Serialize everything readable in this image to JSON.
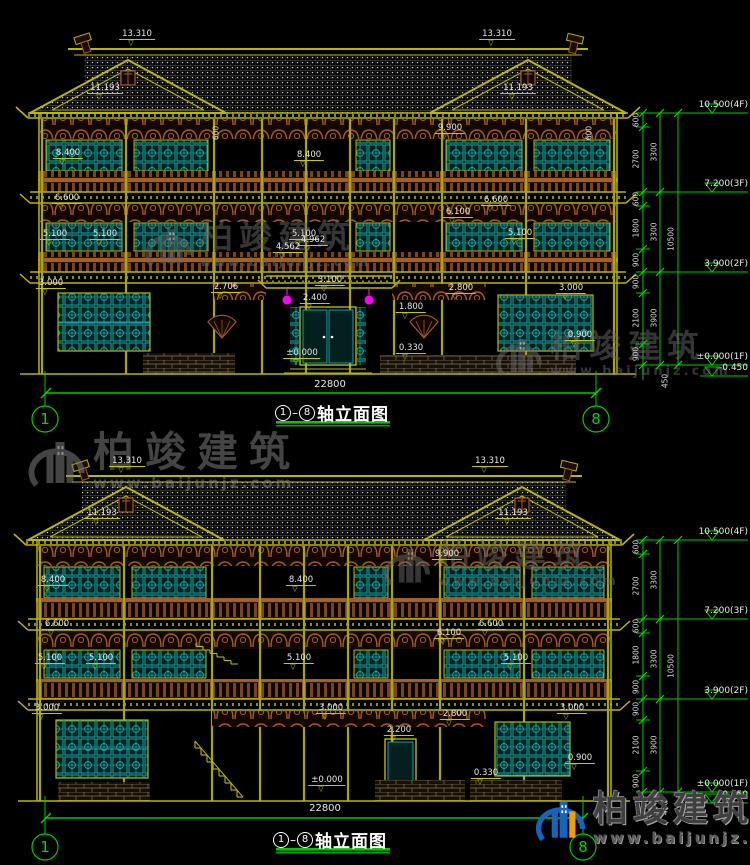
{
  "page": {
    "bg": "#000000",
    "width": 750,
    "height": 865
  },
  "colors": {
    "cad_yellow": "#b8b800",
    "dim_yellow": "#d6d600",
    "green": "#00cc00",
    "teal": "#12a3a3",
    "brown": "#a05a28",
    "magenta": "#ff00ff",
    "tile_gray": "#8f8f8f",
    "text_white": "#e8e8e8"
  },
  "watermark": {
    "brand": "柏竣建筑",
    "url": "www.baijunjz.com",
    "instances": [
      {
        "x": 143,
        "y": 220,
        "fs": 33,
        "ls": 6,
        "logo_h": 55,
        "color": "#6b6b6b",
        "opacity": 0.5,
        "colorful": false,
        "url_fs": 12
      },
      {
        "x": 494,
        "y": 330,
        "fs": 32,
        "ls": 7,
        "logo_h": 54,
        "color": "#6b6b6b",
        "opacity": 0.5,
        "colorful": false,
        "url_fs": 13
      },
      {
        "x": 26,
        "y": 431,
        "fs": 41,
        "ls": 11,
        "logo_h": 66,
        "color": "#7d7d7d",
        "opacity": 0.55,
        "colorful": false,
        "url_fs": 15
      },
      {
        "x": 382,
        "y": 540,
        "fs": 32,
        "ls": 6,
        "logo_h": 54,
        "color": "#6b6b6b",
        "opacity": 0.5,
        "colorful": false,
        "url_fs": 13
      },
      {
        "x": 534,
        "y": 792,
        "fs": 35,
        "ls": 5,
        "logo_h": 58,
        "color": "#3f3f3f",
        "opacity": 1,
        "colorful": true,
        "url_fs": 15
      }
    ]
  },
  "drawings": [
    {
      "name": "front-elevation",
      "title": {
        "axis_from": "1",
        "axis_to": "8",
        "text": "轴立面图"
      },
      "title_pos": {
        "x": 332,
        "y": 400
      },
      "width_dim": {
        "text": "22800",
        "x": 330,
        "y": 390,
        "line_y": 393,
        "x1": 46,
        "x2": 596
      },
      "axes": [
        {
          "n": "1",
          "x": 45
        },
        {
          "n": "8",
          "x": 596
        }
      ],
      "axis_cy": 419,
      "annotations": [
        {
          "t": "13.310",
          "x": 137,
          "y": 46
        },
        {
          "t": "13.310",
          "x": 497,
          "y": 46
        },
        {
          "t": "11.193",
          "x": 105,
          "y": 100
        },
        {
          "t": "11.193",
          "x": 518,
          "y": 100
        },
        {
          "t": "9.900",
          "x": 450,
          "y": 140
        },
        {
          "t": "8.400",
          "x": 68,
          "y": 165
        },
        {
          "t": "8.400",
          "x": 309,
          "y": 167
        },
        {
          "t": "6.600",
          "x": 67,
          "y": 210
        },
        {
          "t": "6.600",
          "x": 496,
          "y": 212
        },
        {
          "t": "6.100",
          "x": 458,
          "y": 224
        },
        {
          "t": "5.100",
          "x": 55,
          "y": 246
        },
        {
          "t": "5.100",
          "x": 105,
          "y": 246
        },
        {
          "t": "5.100",
          "x": 304,
          "y": 246
        },
        {
          "t": "5.100",
          "x": 520,
          "y": 245
        },
        {
          "t": "4.962",
          "x": 313,
          "y": 252
        },
        {
          "t": "4.562",
          "x": 288,
          "y": 259
        },
        {
          "t": "3.100",
          "x": 330,
          "y": 292
        },
        {
          "t": "2.400",
          "x": 315,
          "y": 310
        },
        {
          "t": "3.000",
          "x": 51,
          "y": 295
        },
        {
          "t": "3.000",
          "x": 571,
          "y": 300
        },
        {
          "t": "2.706",
          "x": 226,
          "y": 299
        },
        {
          "t": "2.800",
          "x": 461,
          "y": 300
        },
        {
          "t": "1.800",
          "x": 411,
          "y": 319
        },
        {
          "t": "0.900",
          "x": 580,
          "y": 347
        },
        {
          "t": "0.330",
          "x": 411,
          "y": 360
        },
        {
          "t": "±0.000",
          "x": 302,
          "y": 365
        },
        {
          "t": "600",
          "x": 216,
          "y": 133,
          "rot": true
        },
        {
          "t": "600",
          "x": 589,
          "y": 133,
          "rot": true
        }
      ],
      "right_col": {
        "levels": [
          {
            "t": "10.500(4F)",
            "line_y": 113
          },
          {
            "t": "7.200(3F)",
            "line_y": 192
          },
          {
            "t": "3.900(2F)",
            "line_y": 272
          },
          {
            "t": "±0.000(1F)",
            "line_y": 365
          },
          {
            "t": "-0.450",
            "line_y": 376,
            "minor": true
          }
        ],
        "vdims": [
          {
            "t": "600",
            "x": 636,
            "y": 120
          },
          {
            "t": "2700",
            "x": 636,
            "y": 159
          },
          {
            "t": "600",
            "x": 636,
            "y": 199
          },
          {
            "t": "1800",
            "x": 636,
            "y": 228
          },
          {
            "t": "900",
            "x": 636,
            "y": 260
          },
          {
            "t": "900",
            "x": 636,
            "y": 282
          },
          {
            "t": "2100",
            "x": 636,
            "y": 318
          },
          {
            "t": "900",
            "x": 636,
            "y": 354
          },
          {
            "t": "3300",
            "x": 654,
            "y": 152
          },
          {
            "t": "3300",
            "x": 654,
            "y": 232
          },
          {
            "t": "3900",
            "x": 654,
            "y": 318
          },
          {
            "t": "10500",
            "x": 671,
            "y": 239
          },
          {
            "t": "450",
            "x": 665,
            "y": 381
          }
        ]
      }
    },
    {
      "name": "back-elevation",
      "title": {
        "axis_from": "1",
        "axis_to": "8",
        "text": "轴立面图"
      },
      "title_pos": {
        "x": 330,
        "y": 827
      },
      "width_dim": {
        "text": "22800",
        "x": 325,
        "y": 814,
        "line_y": 818,
        "x1": 46,
        "x2": 583
      },
      "axes": [
        {
          "n": "1",
          "x": 45
        },
        {
          "n": "8",
          "x": 583
        }
      ],
      "axis_cy": 847,
      "annotations": [
        {
          "t": "13.310",
          "x": 127,
          "y": 473
        },
        {
          "t": "13.310",
          "x": 490,
          "y": 473
        },
        {
          "t": "11.193",
          "x": 102,
          "y": 525
        },
        {
          "t": "11.193",
          "x": 513,
          "y": 525
        },
        {
          "t": "9.900",
          "x": 447,
          "y": 566
        },
        {
          "t": "8.400",
          "x": 53,
          "y": 592
        },
        {
          "t": "8.400",
          "x": 301,
          "y": 592
        },
        {
          "t": "6.600",
          "x": 57,
          "y": 636
        },
        {
          "t": "6.600",
          "x": 491,
          "y": 636
        },
        {
          "t": "6.100",
          "x": 449,
          "y": 645
        },
        {
          "t": "5.100",
          "x": 50,
          "y": 670
        },
        {
          "t": "5.100",
          "x": 101,
          "y": 670
        },
        {
          "t": "5.100",
          "x": 299,
          "y": 670
        },
        {
          "t": "5.100",
          "x": 516,
          "y": 670
        },
        {
          "t": "3.000",
          "x": 47,
          "y": 720
        },
        {
          "t": "3.000",
          "x": 331,
          "y": 720
        },
        {
          "t": "3.000",
          "x": 572,
          "y": 720
        },
        {
          "t": "2.800",
          "x": 455,
          "y": 726
        },
        {
          "t": "2.200",
          "x": 399,
          "y": 742
        },
        {
          "t": "0.900",
          "x": 580,
          "y": 770
        },
        {
          "t": "0.330",
          "x": 486,
          "y": 785
        },
        {
          "t": "±0.000",
          "x": 327,
          "y": 792
        }
      ],
      "right_col": {
        "levels": [
          {
            "t": "10.500(4F)",
            "line_y": 540
          },
          {
            "t": "7.200(3F)",
            "line_y": 619
          },
          {
            "t": "3.900(2F)",
            "line_y": 699
          },
          {
            "t": "±0.000(1F)",
            "line_y": 792
          },
          {
            "t": "-0.450",
            "line_y": 803,
            "minor": true
          }
        ],
        "vdims": [
          {
            "t": "600",
            "x": 636,
            "y": 547
          },
          {
            "t": "2700",
            "x": 636,
            "y": 586
          },
          {
            "t": "600",
            "x": 636,
            "y": 626
          },
          {
            "t": "1800",
            "x": 636,
            "y": 655
          },
          {
            "t": "900",
            "x": 636,
            "y": 687
          },
          {
            "t": "900",
            "x": 636,
            "y": 709
          },
          {
            "t": "2100",
            "x": 636,
            "y": 745
          },
          {
            "t": "900",
            "x": 636,
            "y": 781
          },
          {
            "t": "3300",
            "x": 654,
            "y": 580
          },
          {
            "t": "3300",
            "x": 654,
            "y": 659
          },
          {
            "t": "3900",
            "x": 654,
            "y": 745
          },
          {
            "t": "10500",
            "x": 671,
            "y": 666
          },
          {
            "t": "450",
            "x": 665,
            "y": 808
          }
        ]
      }
    }
  ]
}
